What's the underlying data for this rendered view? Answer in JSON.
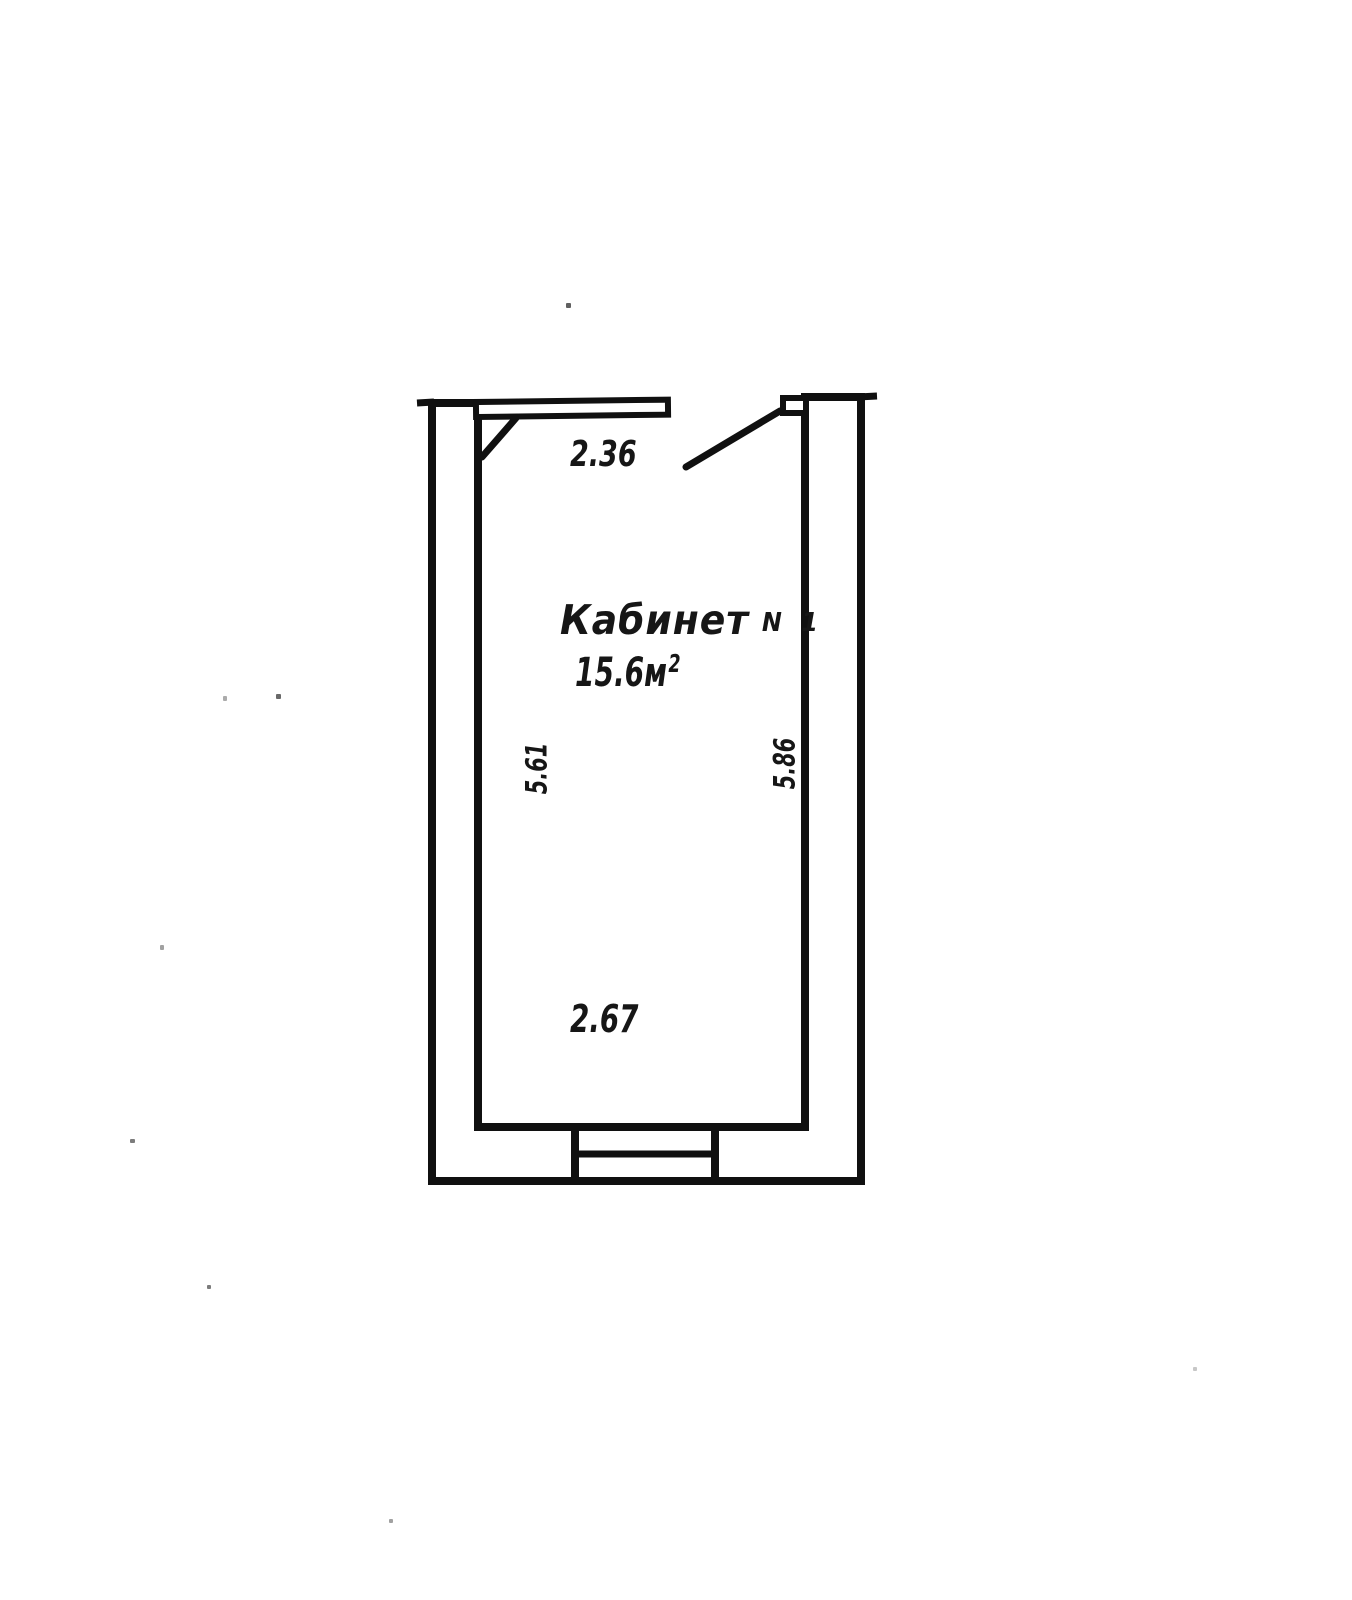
{
  "colors": {
    "paper": "#ffffff",
    "ink": "#101010"
  },
  "plan": {
    "room_name": "Кабинет",
    "room_number": "N 1",
    "area": {
      "value": "15.6",
      "unit": "м",
      "exponent": "2"
    },
    "dimensions": {
      "top_width": "2.36",
      "left_height": "5.61",
      "right_height": "5.86",
      "bottom_width": "2.67"
    }
  }
}
